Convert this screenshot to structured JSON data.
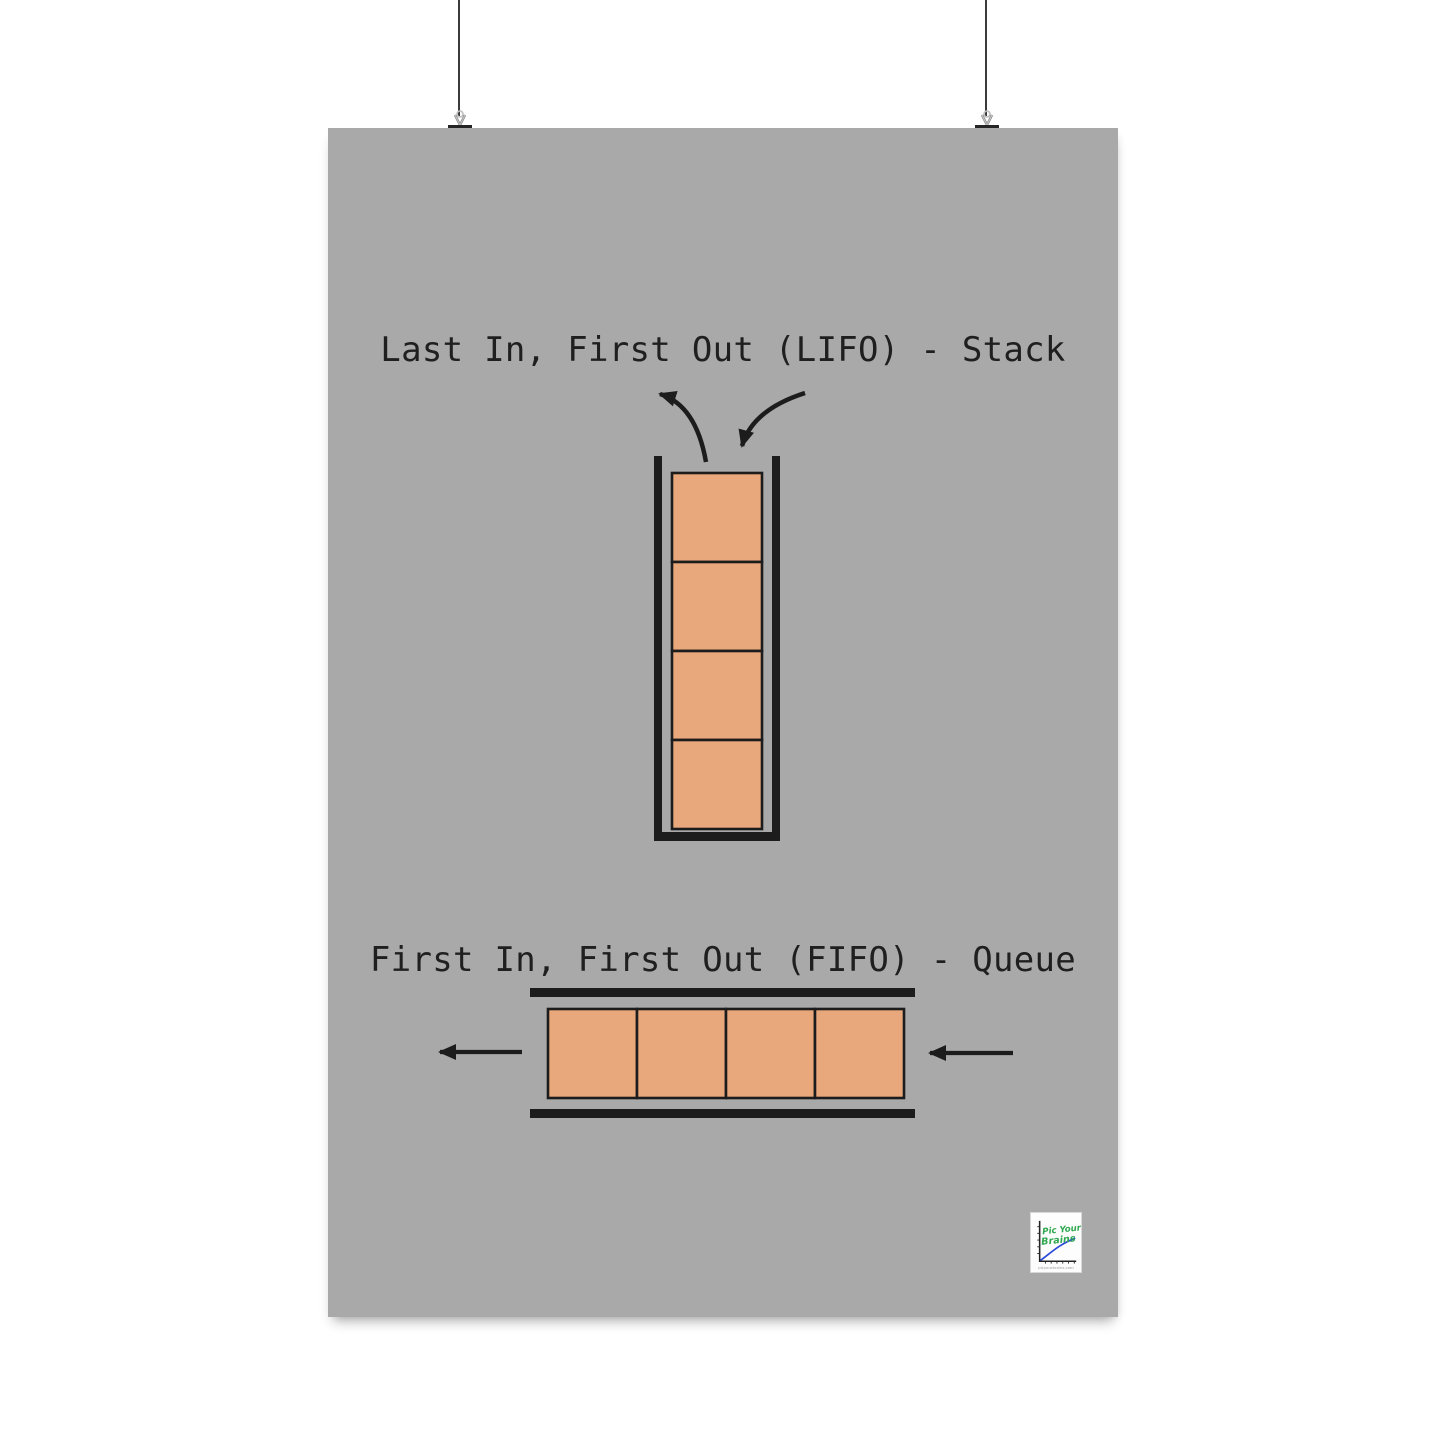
{
  "colors": {
    "poster-bg": "#a9a9a9",
    "outline": "#1c1c1c",
    "box-fill": "#e8a87c",
    "string": "#3b3b3b",
    "title-text": "#1f1f1f",
    "logo-green": "#2fa84f",
    "logo-blue": "#2c4bd8"
  },
  "poster": {
    "lifo": {
      "title": "Last In, First Out (LIFO) - Stack",
      "box_count": 4
    },
    "fifo": {
      "title": "First In, First Out (FIFO) - Queue",
      "box_count": 4
    },
    "logo": {
      "line1": "Pic Your",
      "line2": "Brains",
      "url": "picyourbrains.com"
    }
  }
}
